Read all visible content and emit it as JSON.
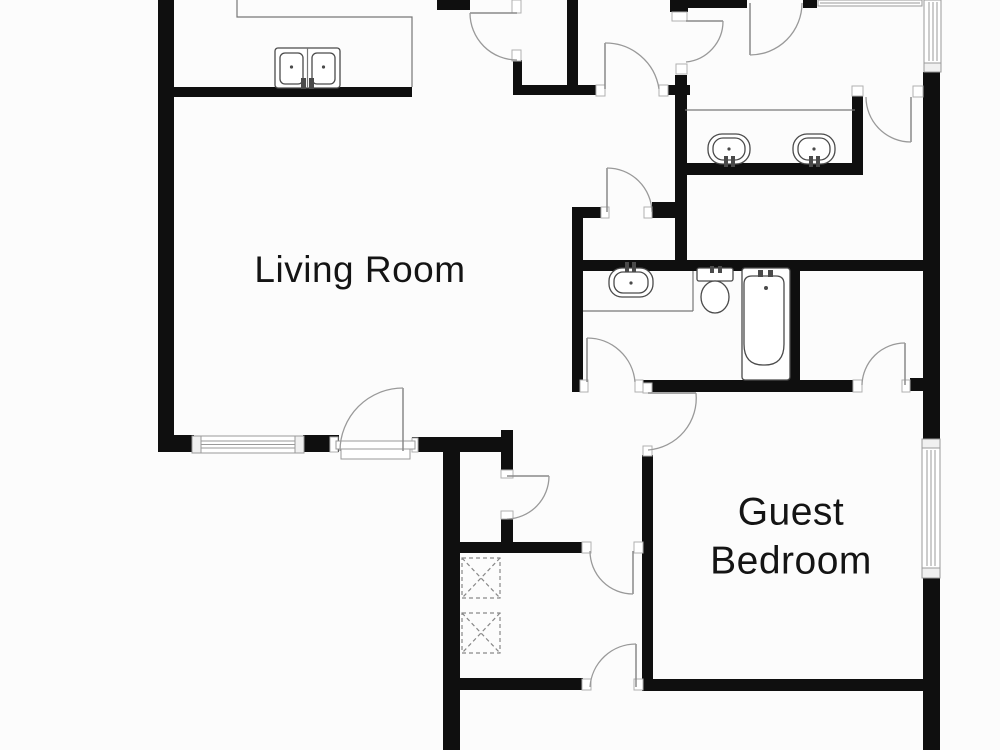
{
  "title": "Floor Plan",
  "colors": {
    "bg": "#fcfcfc",
    "wall": "#0f0f0f",
    "arc": "#999999",
    "leaf": "#8a8a8a",
    "fixture": "#4a4a4a",
    "text": "#141414"
  },
  "rooms": {
    "living_room": {
      "label": "Living Room"
    },
    "guest_bedroom": {
      "label": "Guest Bedroom"
    }
  },
  "fixtures": {
    "kitchen_sink": "kitchen-double-sink-icon",
    "vanity_sink_left": "oval-sink-icon",
    "vanity_sink_right": "oval-sink-icon",
    "bath_sink": "oval-sink-icon",
    "toilet": "toilet-icon",
    "bathtub": "bathtub-icon",
    "washer": "washer-dashed-box-icon",
    "dryer": "dryer-dashed-box-icon"
  }
}
